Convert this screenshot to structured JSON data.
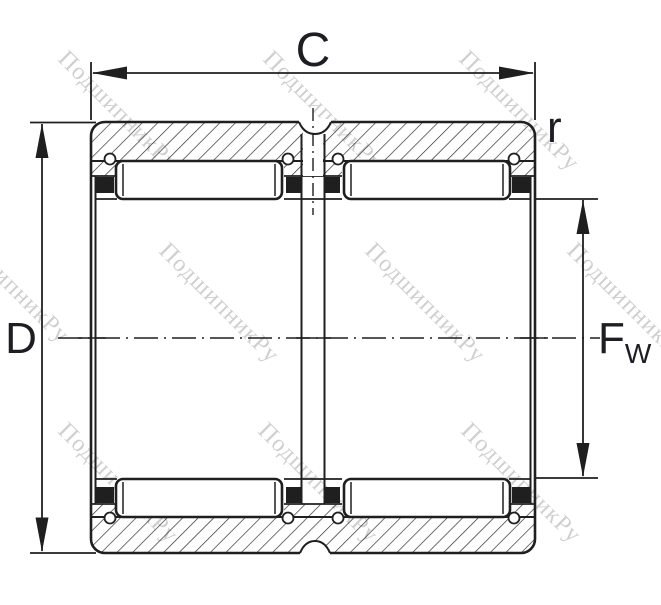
{
  "drawing": {
    "title_hint": "needle roller bearing double-row section",
    "labels": {
      "width": "C",
      "outer_diameter": "D",
      "bore_main": "F",
      "bore_sub": "W",
      "chamfer": "r"
    },
    "watermark": {
      "text": "ПодшипникРу"
    },
    "colors": {
      "line": "#1f1f1f",
      "watermark": "#8f8f8f",
      "background": "#ffffff"
    }
  }
}
